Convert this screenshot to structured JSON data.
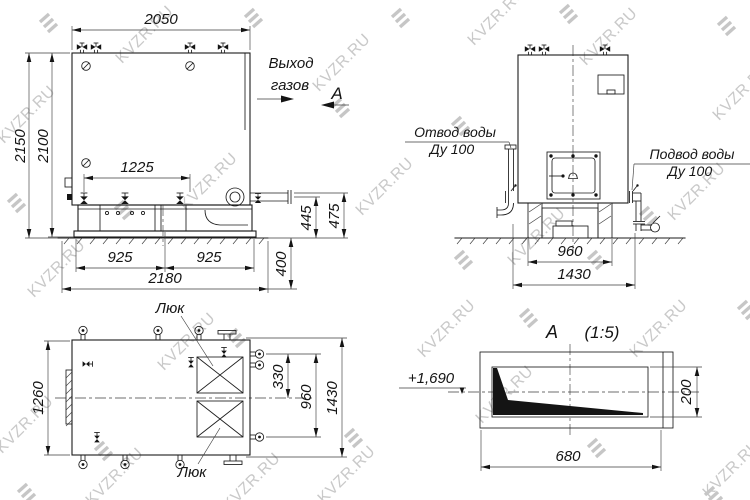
{
  "watermark": {
    "text": "KVZR.RU"
  },
  "front_view": {
    "gas_outlet_line1": "Выход",
    "gas_outlet_line2": "газов",
    "section_arrow_letter": "А",
    "dim_top_width": "2050",
    "dim_height_total": "2150",
    "dim_height_body": "2100",
    "dim_nozzle_spacing": "1225",
    "dim_outlet_axis_height": "445",
    "dim_outlet_top_height": "475",
    "dim_foundation_depth": "400",
    "dim_base_left": "925",
    "dim_base_right": "925",
    "dim_base_total": "2180"
  },
  "side_view": {
    "water_outlet_label": "Отвод воды",
    "water_outlet_size": "Ду 100",
    "water_inlet_label": "Подвод воды",
    "water_inlet_size": "Ду 100",
    "dim_base_width": "960",
    "dim_total_width": "1430"
  },
  "plan_view": {
    "hatch_top_label": "Люк",
    "hatch_bottom_label": "Люк",
    "dim_width": "1260",
    "dim_port_offset": "330",
    "dim_port_span": "960",
    "dim_total_depth": "1430"
  },
  "section_view": {
    "title_letter": "А",
    "title_scale": "(1:5)",
    "elevation_mark": "+1,690",
    "dim_height": "200",
    "dim_width": "680"
  }
}
